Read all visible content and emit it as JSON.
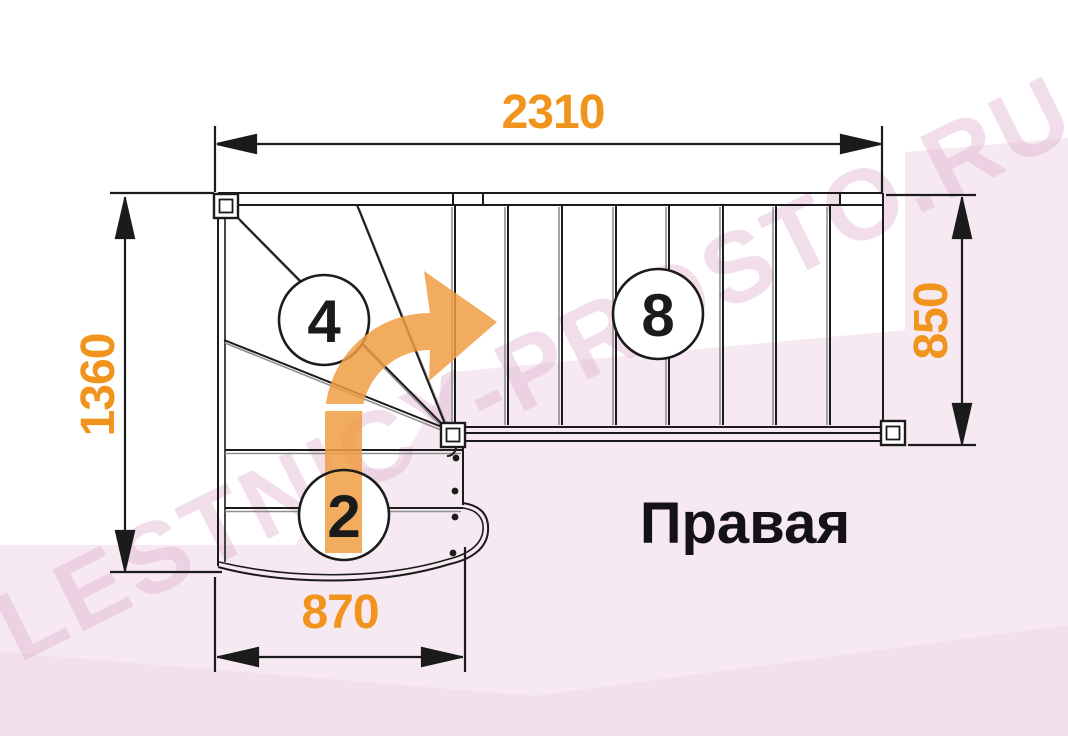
{
  "diagram": {
    "title": "Правая",
    "watermark": "LESTNICY-PROSTO.RU",
    "dimensions": {
      "top_mm": "2310",
      "left_mm": "1360",
      "right_mm": "850",
      "bottom_mm": "870"
    },
    "steps": {
      "winder_count": "4",
      "lower_flight_count": "2",
      "upper_flight_count": "8"
    },
    "colors": {
      "dimension_text": "#F0941D",
      "direction_arrow": "#F09D44",
      "drawing_line": "#1B1B1B",
      "line_shadow": "#8F8F8F",
      "background_pink": "#F6E9F2",
      "watermark_text": "#DBACCA"
    }
  }
}
